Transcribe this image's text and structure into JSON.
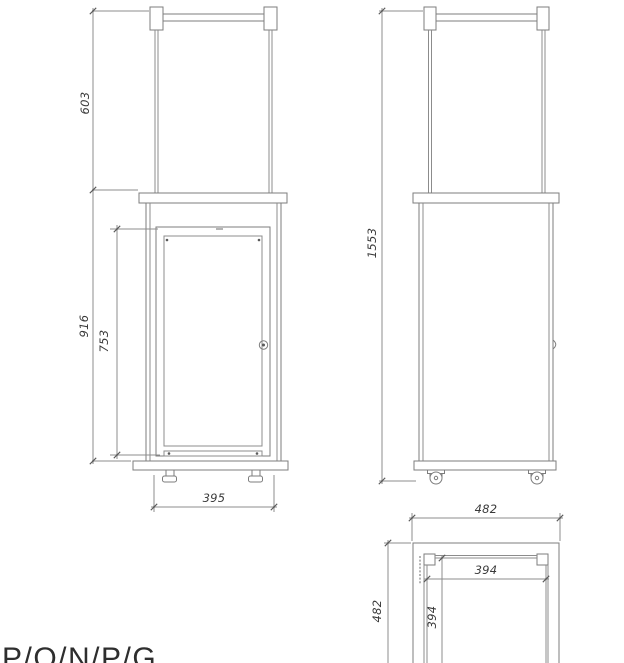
{
  "drawing": {
    "front_view": {
      "dim_top_section": "603",
      "dim_body_height": "916",
      "dim_window_height": "753",
      "dim_width": "395"
    },
    "side_view": {
      "dim_total_height": "1553"
    },
    "top_view": {
      "dim_overall_width": "482",
      "dim_overall_depth": "482",
      "dim_inner_width": "394",
      "dim_inner_depth": "394"
    },
    "footer_text": "P/O/N/P/G",
    "colors": {
      "line": "#7d7d7d",
      "dimension_line": "#8c8c8c",
      "text": "#3a3a3a",
      "background": "#ffffff"
    }
  }
}
